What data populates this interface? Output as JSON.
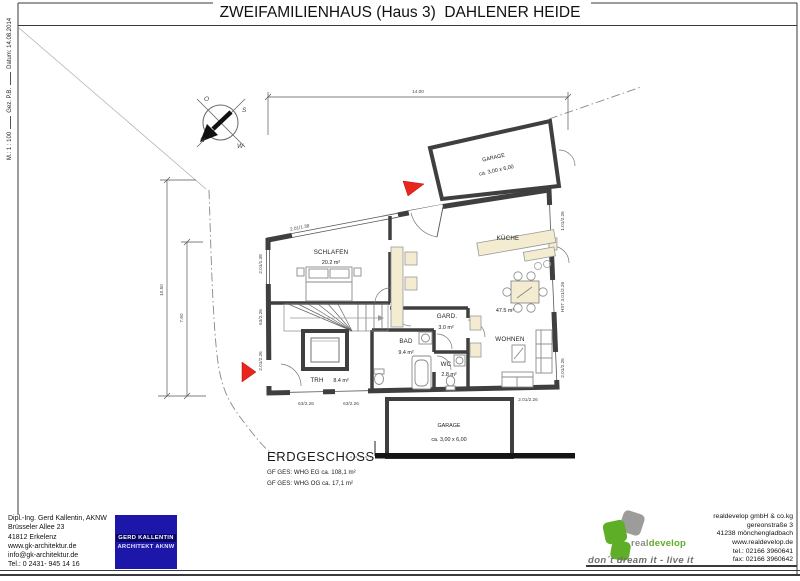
{
  "title": "ZWEIFAMILIENHAUS (Haus 3)  DAHLENER HEIDE",
  "margin": {
    "scale": "M.: 1 : 100",
    "drawn_by": "Gez. P.B.",
    "date": "Datum: 14.08.2014"
  },
  "plan": {
    "compass": {
      "o": "O",
      "s": "S",
      "n": "N",
      "w": "W"
    },
    "dims": {
      "top": "14.00",
      "left_outer": "10.50",
      "left_inner": "7.50",
      "slant_top": "2.01/1.38",
      "left_top": "2.01/1.38",
      "left_mid": "63/2.26",
      "left_bottom": "2.01/2.26",
      "bottom_a": "63/2.26",
      "bottom_b": "63/2.26",
      "bottom_right": "2.01/2.26",
      "right_top": "1.01/2.26",
      "right_mid": "HST 3.01/2.26",
      "right_bottom": "2.01/2.26"
    },
    "rooms": {
      "schlafen": {
        "name": "SCHLAFEN",
        "area": "20.2 m²"
      },
      "kueche": {
        "name": "KÜCHE"
      },
      "wohnen": {
        "name": "WOHNEN",
        "area": "47.5 m²"
      },
      "bad": {
        "name": "BAD",
        "area": "9.4 m²"
      },
      "wc": {
        "name": "WC",
        "area": "2.8 m²"
      },
      "gard": {
        "name": "GARD.",
        "area": "3.0 m²"
      },
      "trh": {
        "name": "TRH",
        "area": "8.4 m²"
      },
      "garage_top": {
        "name": "GARAGE",
        "size": "ca. 3,00 x 6,00"
      },
      "garage_bottom": {
        "name": "GARAGE",
        "size": "ca. 3,00 x 6,00"
      }
    },
    "floor": {
      "label": "ERDGESCHOSS",
      "summary1": "GF GES: WHG EG ca. 108,1 m²",
      "summary2": "GF GES: WHG OG ca. 17,1 m²"
    }
  },
  "architect": {
    "lines": [
      "Dipl.-Ing. Gerd Kallentin, AKNW",
      "Brüsseler Allee 23",
      "41812 Erkelenz",
      "www.gk-architektur.de",
      "info@gk-architektur.de",
      "Tel.: 0 2431- 945 14 16"
    ],
    "logo_line1": "GERD KALLENTIN",
    "logo_line2": "ARCHITEKT AKNW"
  },
  "developer": {
    "name_gray": "real",
    "name_green": "develop",
    "tagline": "don´t dream it - live it",
    "lines": [
      "realdevelop gmbH & co.kg",
      "gereonstraße 3",
      "41238 mönchengladbach",
      "www.realdevelop.de",
      "tel.: 02166 3960641",
      "fax: 02166 3960642"
    ]
  },
  "colors": {
    "wall": "#3f3f3f",
    "furniture_fill": "#f3ecd1",
    "red_marker": "#e8251f",
    "logo_blue": "#1c17a8",
    "brand_green": "#5fae27",
    "brand_gray": "#8c8c8a"
  }
}
